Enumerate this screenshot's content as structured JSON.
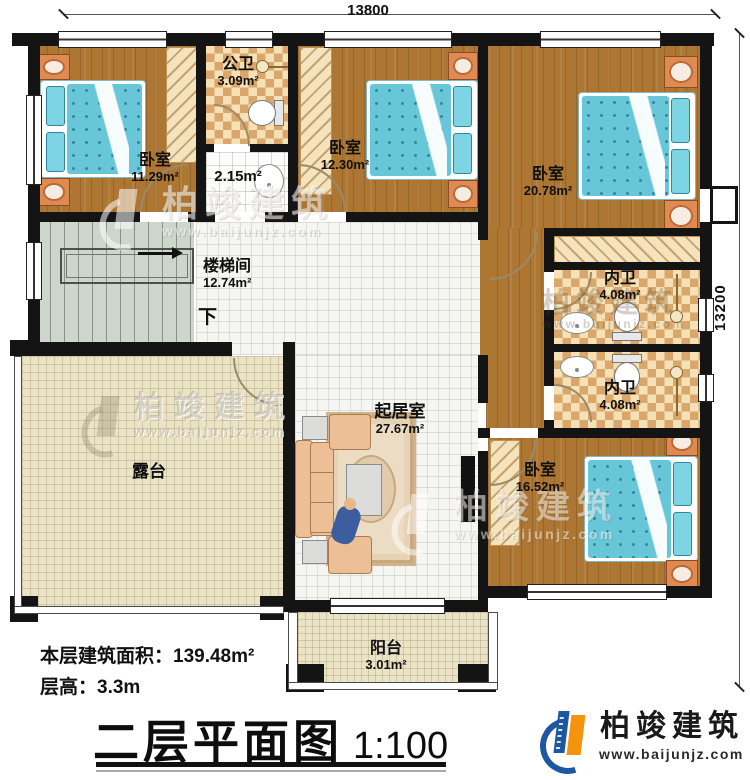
{
  "dimensions": {
    "top": "13800",
    "right": "13200"
  },
  "rooms": {
    "bedroom1": {
      "name": "卧室",
      "area": "11.29m²"
    },
    "public_bath": {
      "name": "公卫",
      "area": "3.09m²"
    },
    "vestibule": {
      "area": "2.15m²"
    },
    "bedroom2": {
      "name": "卧室",
      "area": "12.30m²"
    },
    "bedroom3": {
      "name": "卧室",
      "area": "20.78m²"
    },
    "stair_hall": {
      "name": "楼梯间",
      "area": "12.74m²",
      "direction": "下"
    },
    "inner_bath_1": {
      "name": "内卫",
      "area": "4.08m²"
    },
    "inner_bath_2": {
      "name": "内卫",
      "area": "4.08m²"
    },
    "living_room": {
      "name": "起居室",
      "area": "27.67m²"
    },
    "bedroom4": {
      "name": "卧室",
      "area": "16.52m²"
    },
    "terrace": {
      "name": "露台"
    },
    "balcony": {
      "name": "阳台",
      "area": "3.01m²"
    }
  },
  "notes": {
    "floor_area": "本层建筑面积：139.48m²",
    "floor_height": "层高：3.3m"
  },
  "title": {
    "text": "二层平面图",
    "scale": "1:100"
  },
  "brand": {
    "company": "柏竣建筑",
    "website": "www.baijunjz.com"
  }
}
